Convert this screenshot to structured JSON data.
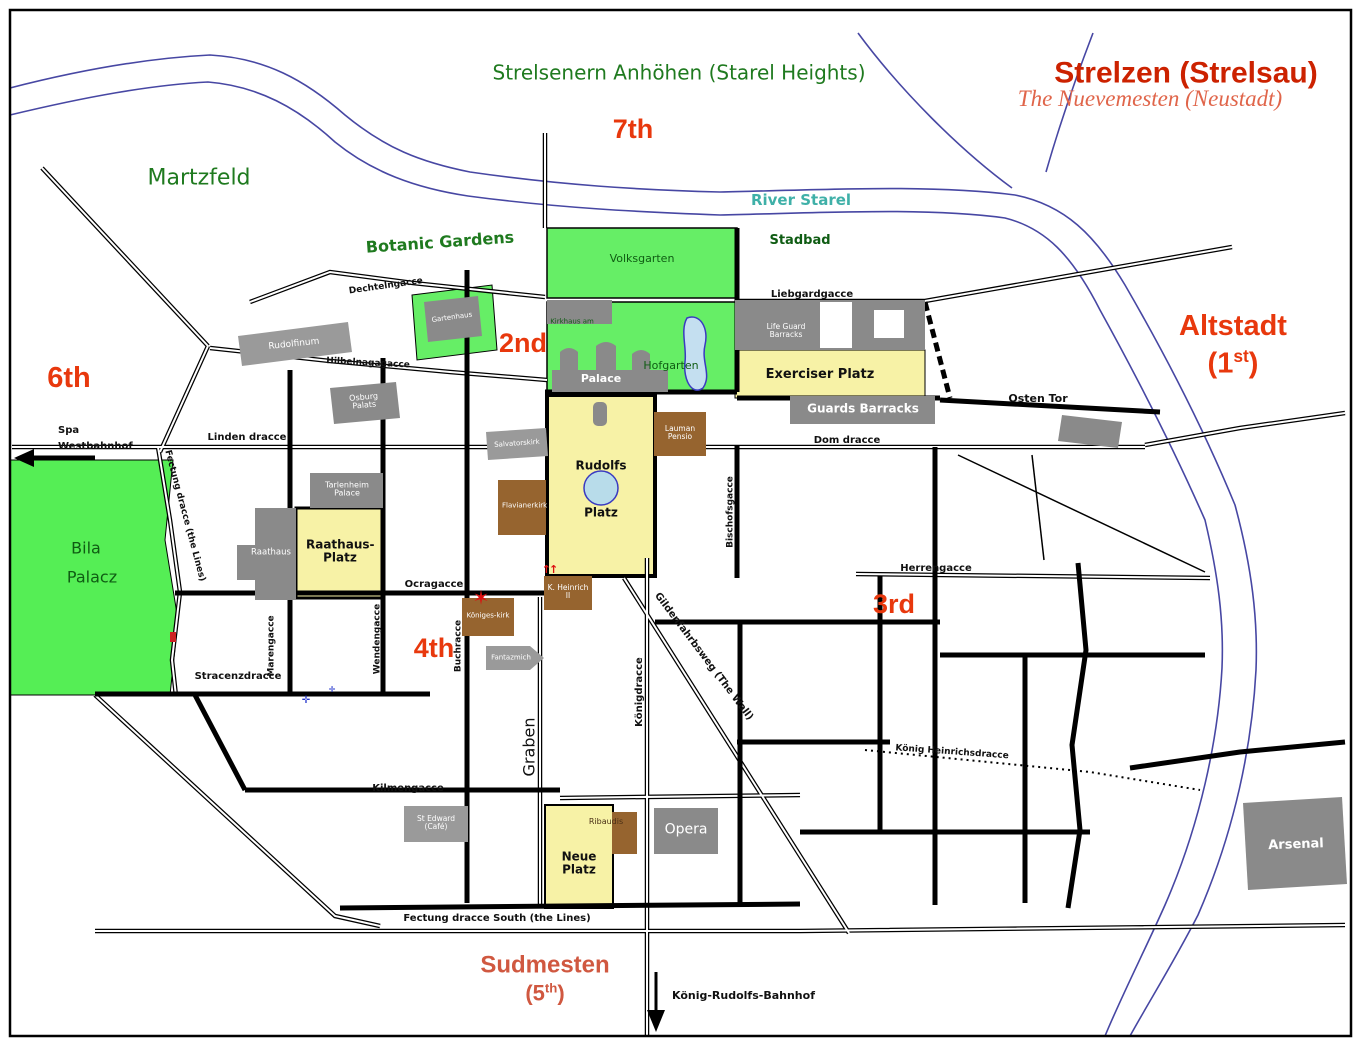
{
  "map": {
    "title": "Strelzen (Strelsau)",
    "subtitle": "The Nuevemesten (Neustadt)",
    "regions": {
      "starel_heights": "Strelsenern Anhöhen (Starel Heights)",
      "martzfeld": "Martzfeld",
      "altstadt": "Altstadt",
      "altstadt_num": "(1",
      "altstadt_num_sup": "st",
      "altstadt_num_close": ")",
      "sudmesten": "Sudmesten",
      "sudmesten_num": "(5",
      "sudmesten_num_sup": "th",
      "sudmesten_num_close": ")"
    },
    "districts": {
      "d2": "2nd",
      "d3": "3rd",
      "d4": "4th",
      "d6": "6th",
      "d7": "7th"
    },
    "water": {
      "river": "River Starel"
    },
    "parks": {
      "volksgarten": "Volksgarten",
      "hofgarten": "Hofgarten",
      "botanic_gardens": "Botanic Gardens",
      "stadbad": "Stadbad",
      "bila_1": "Bila",
      "bila_2": "Palacz"
    },
    "squares": {
      "rudolfs_1": "Rudolfs",
      "rudolfs_2": "Platz",
      "raathaus_platz": "Raathaus-Platz",
      "exerciser_platz": "Exerciser Platz",
      "neue_platz": "Neue Platz"
    },
    "buildings": {
      "palace": "Palace",
      "kirkhaus": "Kirkhaus am",
      "rudolfinum": "Rudolfinum",
      "tarlenheim_palace": "Tarlenheim Palace",
      "osburg_palats": "Osburg Palats",
      "gartenhaus": "Gartenhaus",
      "raathaus": "Raathaus",
      "life_guard_barracks": "Life Guard Barracks",
      "guards_barracks": "Guards Barracks",
      "osten_tor": "Osten Tor",
      "salvatorskirk": "Salvatorskirk",
      "flavianerkirk": "Flavianerkirk",
      "lauman_pensio": "Lauman Pensio",
      "koenigeskirk": "Königes-kirk",
      "k_heinrich": "K. Heinrich II",
      "fantazmich": "Fantazmich",
      "st_edward_cafe": "St Edward (Café)",
      "ribaudis": "Ribaudis",
      "opera": "Opera",
      "arsenal": "Arsenal"
    },
    "streets": {
      "linden": "Linden dracce",
      "liebgard": "Liebgardgacce",
      "dom": "Dom dracce",
      "herren": "Herrengacce",
      "ocra": "Ocragacce",
      "stracenz": "Stracenzdracce",
      "kilmen": "Kilmengacce",
      "fectung_south": "Fectung dracce South (the Lines)",
      "fectung_west": "Fectung dracce (the Lines)",
      "graben": "Graben",
      "koenigdracce": "Königdracce",
      "maren": "Marengacce",
      "wenden": "Wendengacce",
      "buch": "Buchracce",
      "bischofs": "Bischofsgacce",
      "gilden": "Gildenfahrbsweg (The Wall)",
      "koenig_heinrichs": "König Heinrichsdracce",
      "dechteln": "Dechtelngacce",
      "hilbelna": "Hilbelnagagacce"
    },
    "stations": {
      "spa_1": "Spa",
      "spa_2": "Westbahnhof",
      "koenig_rudolfs_bahnhof": "König-Rudolfs-Bahnhof"
    },
    "markers": {
      "star": "✶",
      "red_arrows": "↑↑",
      "blue_cross": "✛"
    },
    "colors": {
      "district_red": "#e8380d",
      "title_red": "#cc2200",
      "region_green": "#1f7a1f",
      "park_green": "#66ee66",
      "platz_yellow": "#f7f2a6",
      "building_gray": "#8a8a8a",
      "church_brown": "#96642f",
      "river_blue": "#4747a3",
      "river_teal": "#3fb0a8"
    }
  }
}
